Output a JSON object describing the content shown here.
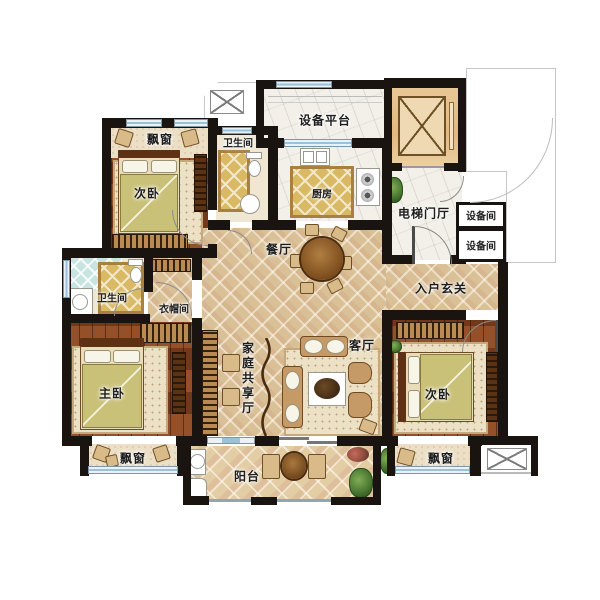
{
  "plan": {
    "type": "residential-floor-plan",
    "language": "zh-CN",
    "rooms": {
      "bay_window_top_left": {
        "label": "飘窗"
      },
      "bedroom_top_left": {
        "label": "次卧"
      },
      "bathroom_top": {
        "label": "卫生间"
      },
      "equipment_platform": {
        "label": "设备平台"
      },
      "kitchen": {
        "label": "厨房"
      },
      "elevator_hall": {
        "label": "电梯门厅"
      },
      "equipment_room_1": {
        "label": "设备间"
      },
      "equipment_room_2": {
        "label": "设备间"
      },
      "dining_room": {
        "label": "餐厅"
      },
      "entry_foyer": {
        "label": "入户玄关"
      },
      "bathroom_master": {
        "label": "卫生间"
      },
      "cloakroom": {
        "label": "衣帽间"
      },
      "master_bedroom": {
        "label": "主卧"
      },
      "family_shared_hall": {
        "label": "家庭共享厅"
      },
      "living_room": {
        "label": "客厅"
      },
      "bedroom_bottom_right": {
        "label": "次卧"
      },
      "bay_window_bottom_left": {
        "label": "飘窗"
      },
      "balcony": {
        "label": "阳台"
      },
      "bay_window_bottom_right": {
        "label": "飘窗"
      }
    },
    "colors": {
      "wall": "#19140f",
      "tile_floor": "#d9c096",
      "wood_floor": "#83401d",
      "gold_tile": "#d9b964",
      "shower_tile": "#c8e4e0",
      "window_glass": "#9cc2d6",
      "elevator_fill": "#e6c091",
      "balcony_tile": "#e2cda4",
      "label_text": "#1d1d1d"
    }
  }
}
